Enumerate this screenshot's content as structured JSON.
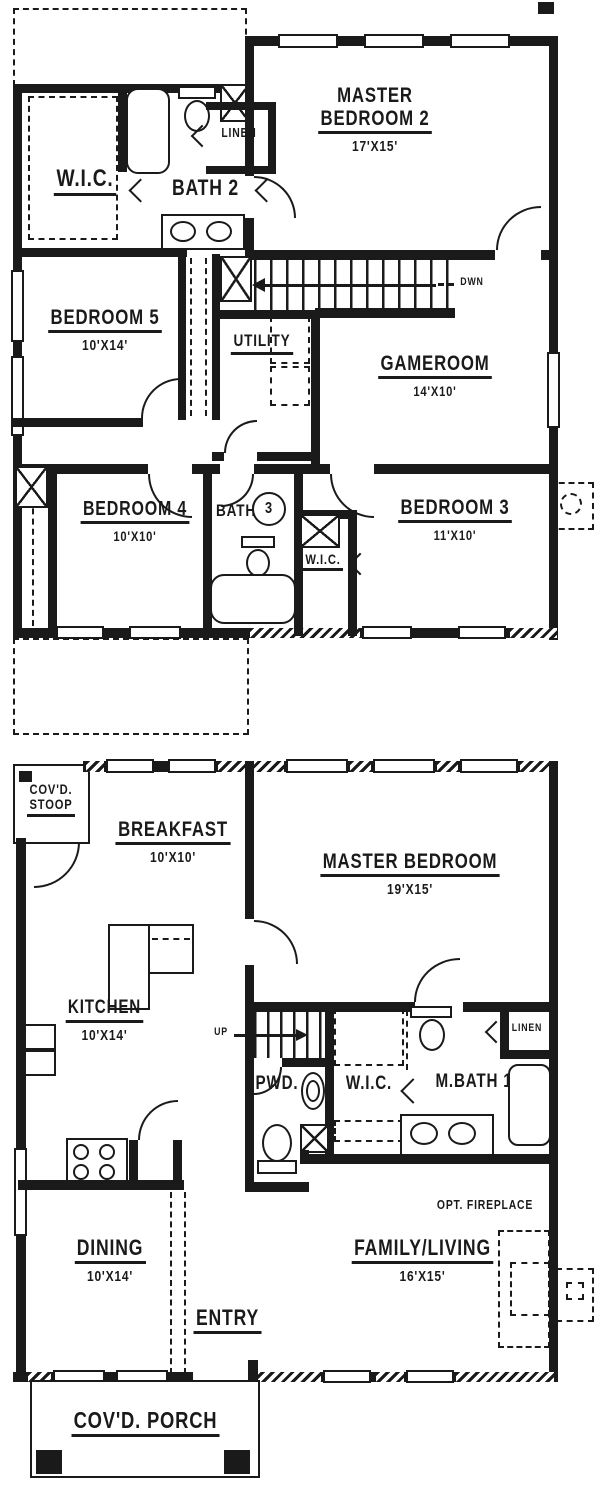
{
  "colors": {
    "ink": "#1a1a1a",
    "paper": "#ffffff"
  },
  "upper_floor": {
    "wic": {
      "name": "W.I.C."
    },
    "bath2": {
      "name": "BATH 2"
    },
    "linen": {
      "name": "LINEN"
    },
    "master_bedroom2": {
      "line1": "MASTER",
      "line2": "BEDROOM 2",
      "dims": "17'X15'"
    },
    "stairs": {
      "label": "DWN"
    },
    "bedroom5": {
      "name": "BEDROOM 5",
      "dims": "10'X14'"
    },
    "utility": {
      "name": "UTILITY"
    },
    "gameroom": {
      "name": "GAMEROOM",
      "dims": "14'X10'"
    },
    "bedroom4": {
      "name": "BEDROOM 4",
      "dims": "10'X10'"
    },
    "bath3": {
      "label": "BATH",
      "number": "3"
    },
    "wic2": {
      "name": "W.I.C."
    },
    "bedroom3": {
      "name": "BEDROOM 3",
      "dims": "11'X10'"
    }
  },
  "lower_floor": {
    "stoop": {
      "line1": "COV'D.",
      "line2": "STOOP"
    },
    "breakfast": {
      "name": "BREAKFAST",
      "dims": "10'X10'"
    },
    "master_bedroom": {
      "name": "MASTER BEDROOM",
      "dims": "19'X15'"
    },
    "kitchen": {
      "name": "KITCHEN",
      "dims": "10'X14'"
    },
    "stairs": {
      "label": "UP"
    },
    "pwd": {
      "name": "PWD."
    },
    "wic": {
      "name": "W.I.C."
    },
    "mbath": {
      "name": "M.BATH 1"
    },
    "linen": {
      "name": "LINEN"
    },
    "dining": {
      "name": "DINING",
      "dims": "10'X14'"
    },
    "entry": {
      "name": "ENTRY"
    },
    "family_living": {
      "name": "FAMILY/LIVING",
      "dims": "16'X15'"
    },
    "fireplace": {
      "label": "OPT. FIREPLACE"
    },
    "porch": {
      "name": "COV'D. PORCH"
    }
  }
}
